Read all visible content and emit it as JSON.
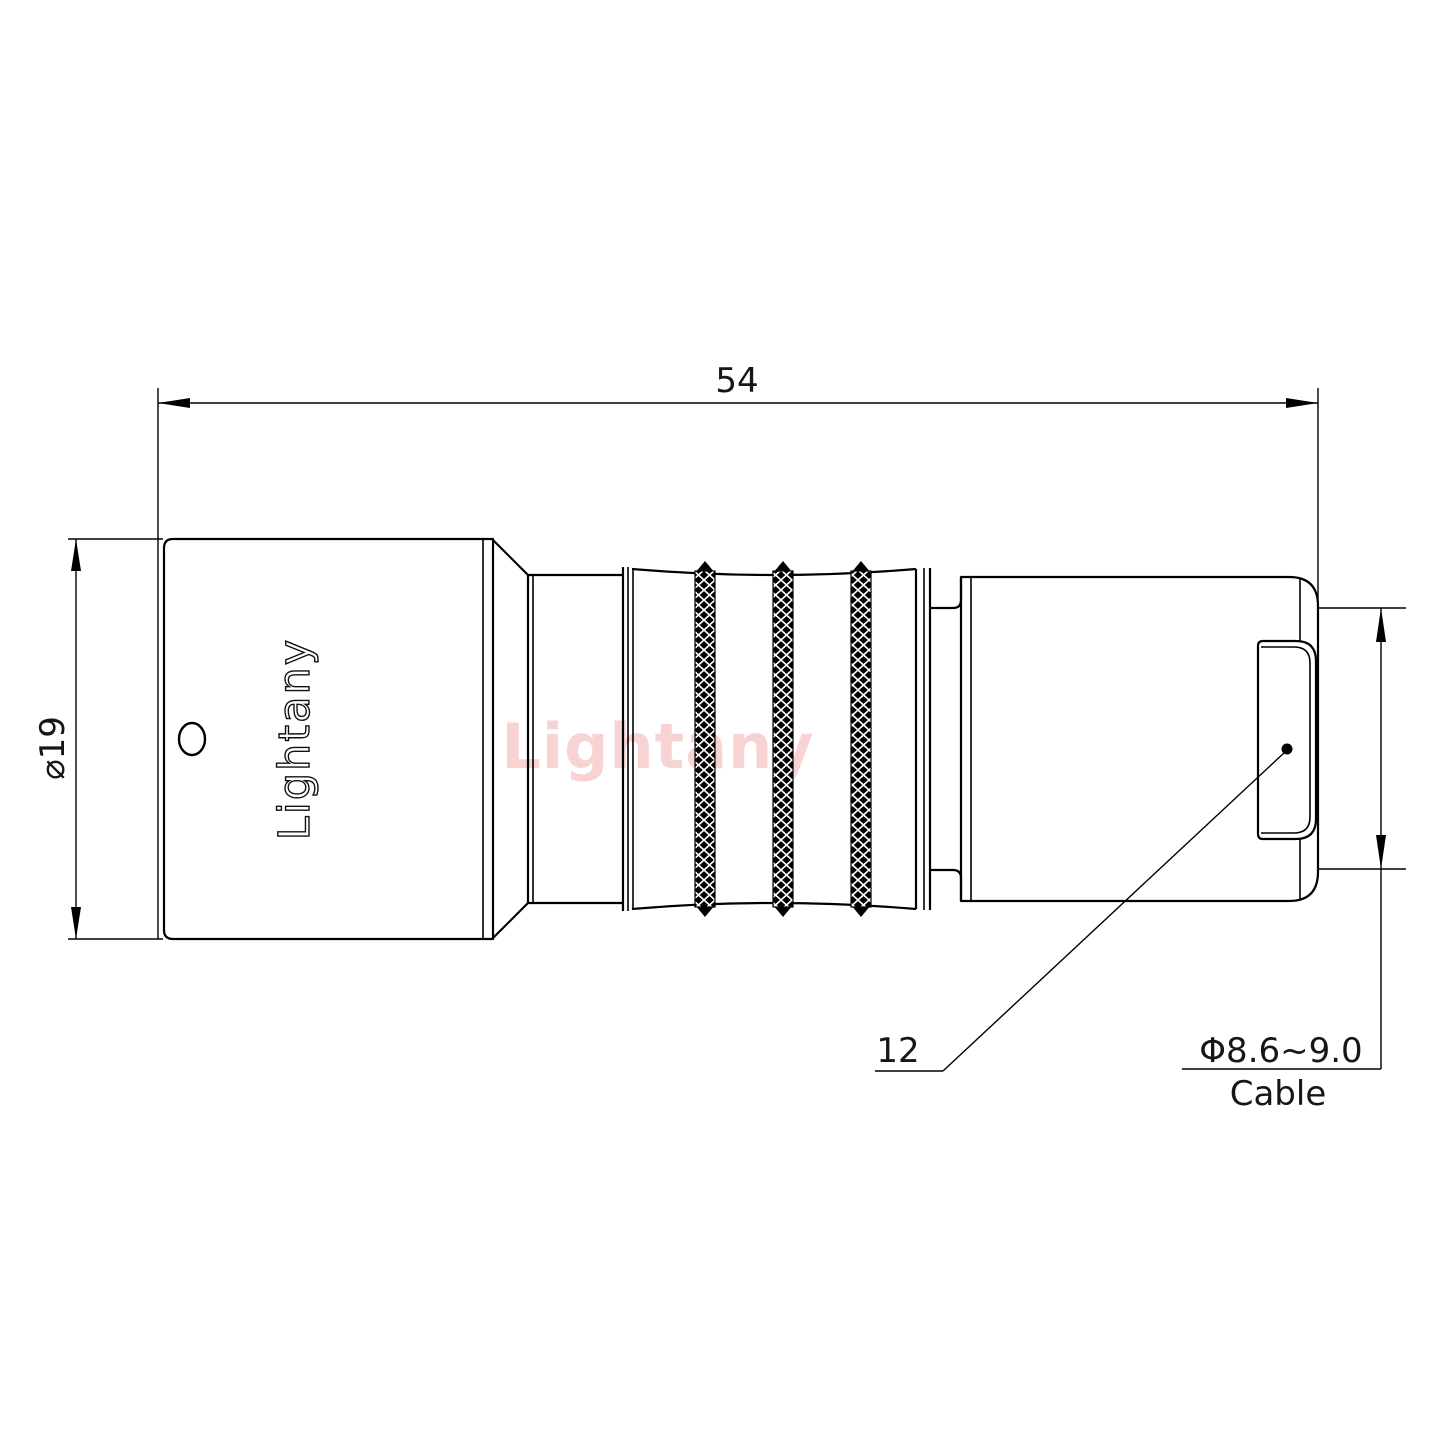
{
  "drawing": {
    "title_dimensions": {
      "overall_length": "54",
      "body_diameter": "⌀19",
      "rear_dim": "12",
      "cable_diameter_range": "Φ8.6~9.0",
      "cable_label": "Cable"
    },
    "branding": {
      "body_logo": "Lightany",
      "watermark": "Lightany"
    },
    "colors": {
      "line": "#000000",
      "watermark_pink": "#f2b6b6",
      "background": "#ffffff"
    }
  }
}
